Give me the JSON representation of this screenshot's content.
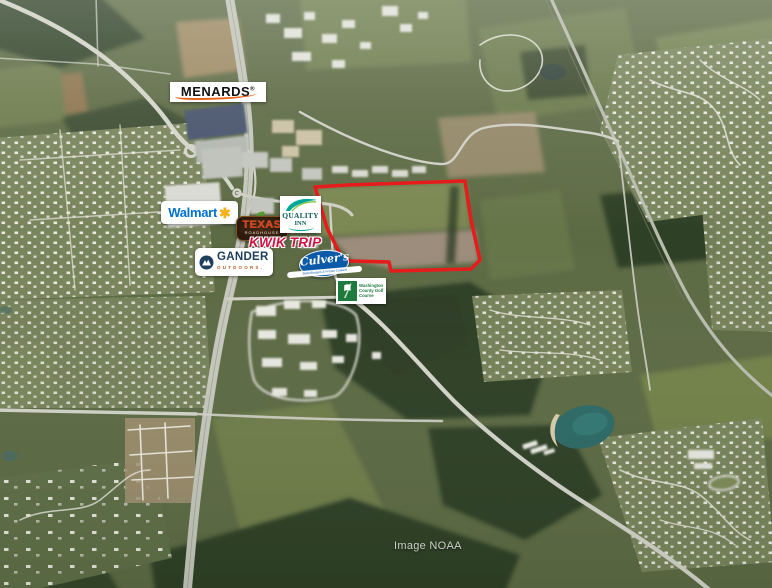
{
  "attribution": {
    "text": "Image NOAA"
  },
  "logos": {
    "menards": {
      "name": "MENARDS",
      "registered": "®"
    },
    "walmart": {
      "name": "Walmart",
      "spark": "✱"
    },
    "texas_roadhouse": {
      "top": "TEXAS",
      "bottom": "ROADHOUSE"
    },
    "quality_inn": {
      "top": "QUALITY",
      "bottom": "INN"
    },
    "kwik_trip": {
      "name": "KWIK TRIP"
    },
    "gander_outdoors": {
      "name": "GANDER",
      "sub": "OUTDOORS."
    },
    "culvers": {
      "name": "Culver's",
      "tagline": "ButterBurgers & Frozen Custard"
    },
    "golf_course": {
      "line1": "Washington",
      "line2": "County Golf",
      "line3": "Course"
    }
  },
  "colors": {
    "parcel_outline": "#e51c1c",
    "walmart_blue": "#0071ce",
    "walmart_spark": "#f6b21b",
    "kwik_trip_red": "#d21242",
    "quality_teal": "#00a79d",
    "gander_navy": "#1d3e5c",
    "gander_orange": "#b05a22",
    "culvers_blue": "#0a5aa8",
    "menards_swoosh": "#e8641b",
    "texas_red": "#e03a26",
    "golf_green": "#1e7b3d"
  }
}
